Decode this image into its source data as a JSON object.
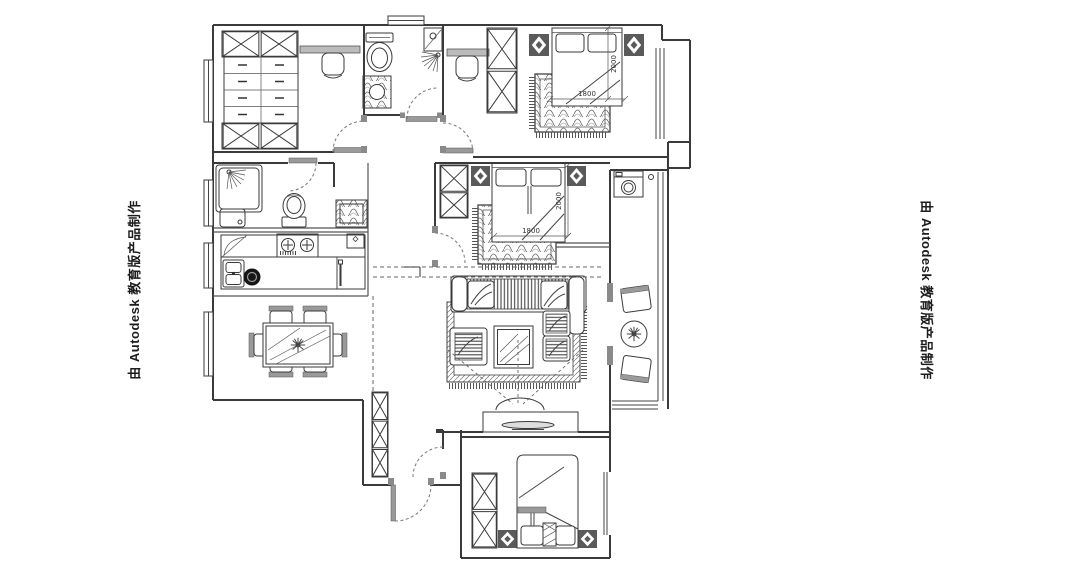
{
  "watermark": {
    "left": "由 Autodesk 教育版产品制作",
    "right": "由 Autodesk 教育版产品制作"
  },
  "dims": {
    "bedroom_top_width": "1800",
    "bedroom_top_depth": "2000",
    "bedroom_master_width": "1800",
    "bedroom_master_depth": "2000"
  },
  "colors": {
    "paper": "#ffffff",
    "wall": "#3a3a3a",
    "fixture_gray": "#9a9a9a",
    "text": "#1c1c1c"
  }
}
